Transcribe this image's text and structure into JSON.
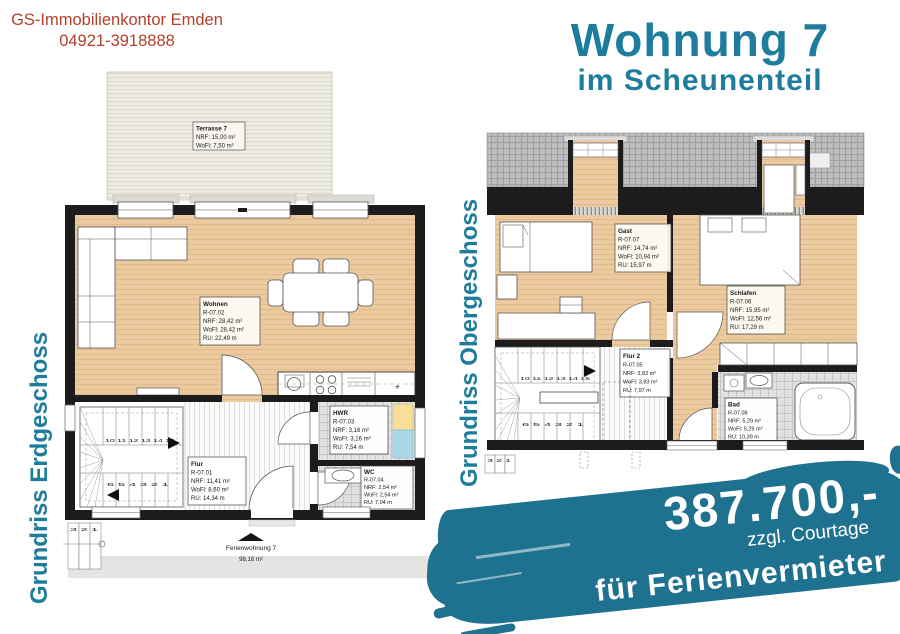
{
  "header": {
    "company": "GS-Immobilienkontor Emden",
    "phone": "04921-3918888"
  },
  "title": {
    "line1": "Wohnung 7",
    "line2": "im Scheunenteil"
  },
  "ground_floor": {
    "label": "Grundriss Erdgeschoss",
    "terrace": {
      "name": "Terrasse 7",
      "nrf": "NRF: 15,00 m²",
      "wofl": "WoFl: 7,50 m²"
    },
    "wohnen": {
      "name": "Wohnen",
      "id": "R-07.02",
      "nrf": "NRF: 28,42 m²",
      "wofl": "WoFl: 28,42 m²",
      "ru": "RU: 22,49 m"
    },
    "flur": {
      "name": "Flur",
      "id": "R-07.01",
      "nrf": "NRF: 11,41 m²",
      "wofl": "WoFl: 8,60 m²",
      "ru": "RU: 14,34 m"
    },
    "hwr": {
      "name": "HWR",
      "id": "R-07.03",
      "nrf": "NRF: 3,16 m²",
      "wofl": "WoFl: 3,16 m²",
      "ru": "RU: 7,54 m"
    },
    "wc": {
      "name": "WC",
      "id": "R-07.04",
      "nrf": "NRF: 2,54 m²",
      "wofl": "WoFl: 2,54 m²",
      "ru": "RU: 7,04 m"
    },
    "stairs_top_numbers": "10 11 12 13 14 15",
    "stairs_bottom_numbers": "6 5 4 3 2 1",
    "exterior_steps": "3 2 1",
    "kitchen_symbol": "✳",
    "footer_name": "Ferienwohnung 7",
    "footer_area": "98,16 m²"
  },
  "upper_floor": {
    "label": "Grundriss Obergeschoss",
    "gast": {
      "name": "Gast",
      "id": "R-07.07",
      "nrf": "NRF: 14,74 m²",
      "wofl": "WoFl: 10,94 m²",
      "ru": "RU: 15,97 m"
    },
    "schlafen": {
      "name": "Schlafen",
      "id": "R-07.06",
      "nrf": "NRF: 15,95 m²",
      "wofl": "WoFl: 12,56 m²",
      "ru": "RU: 17,29 m"
    },
    "flur2": {
      "name": "Flur 2",
      "id": "R-07.05",
      "nrf": "NRF: 3,83 m²",
      "wofl": "WoFl: 3,83 m²",
      "ru": "RU: 7,97 m"
    },
    "bad": {
      "name": "Bad",
      "id": "R-07.08",
      "nrf": "NRF: 5,29 m²",
      "wofl": "WoFl: 5,29 m²",
      "ru": "RU: 10,39 m"
    },
    "stairs_top_numbers": "10 11 12 13 14 15",
    "stairs_bottom_numbers": "6 5 4 3 2 1",
    "exterior_steps": "3 2 1"
  },
  "banner": {
    "price": "387.700,-",
    "note": "zzgl. Courtage",
    "audience": "für Ferienvermieter"
  },
  "colors": {
    "accent": "#1e7d9c",
    "banner": "#1f7190",
    "brand": "#b0402c",
    "floor_tan": "#ecca9f",
    "roof_grey": "#bdbdbd"
  }
}
